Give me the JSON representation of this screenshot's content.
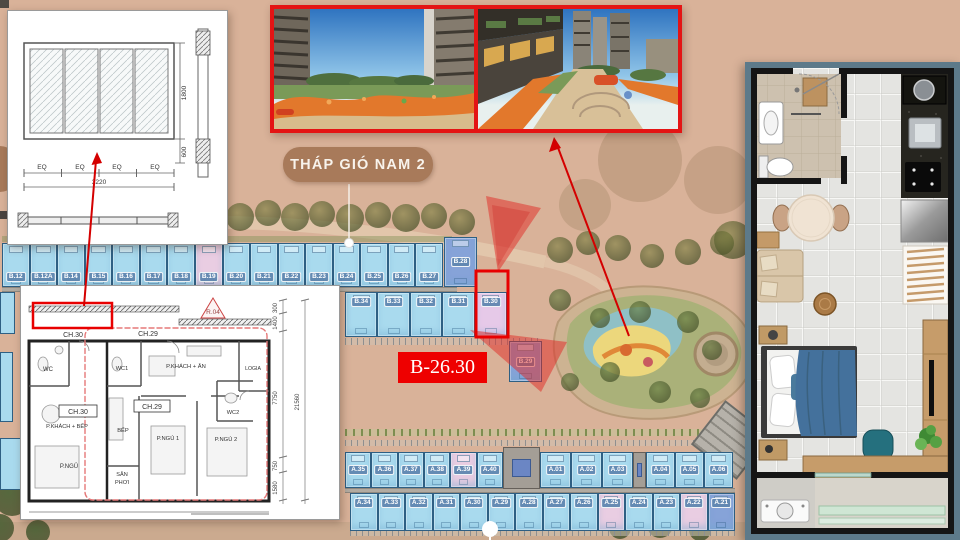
{
  "labels": {
    "tower_label": "THÁP GIÓ NAM 2",
    "unit_code": "B-26.30",
    "partial_tower_letter": "T"
  },
  "window_detail": {
    "height": "1800",
    "sill": "600",
    "total": "3220",
    "eq": "EQ"
  },
  "floor_plan": {
    "ch30": "CH.30",
    "ch29": "CH.29",
    "r04": "R.04",
    "wc": "WC",
    "wc1": "WC1",
    "wc2": "WC2",
    "living30": "P.KHÁCH + BẾP",
    "bed30": "P.NGỦ",
    "living29": "P.KHÁCH + ĂN",
    "logia": "LOGIA",
    "kitchen": "BẾP",
    "bed1": "P.NGỦ 1",
    "bed2": "P.NGỦ 2",
    "san": "SÂN",
    "phoi": "PHƠI",
    "dims": [
      "300",
      "1400",
      "21560",
      "7750",
      "750",
      "1580"
    ]
  },
  "site_plan": {
    "b_top": [
      {
        "label": "B.12",
        "type": "std"
      },
      {
        "label": "B.12A",
        "type": "std"
      },
      {
        "label": "B.14",
        "type": "std"
      },
      {
        "label": "B.15",
        "type": "std"
      },
      {
        "label": "B.16",
        "type": "std"
      },
      {
        "label": "B.17",
        "type": "std"
      },
      {
        "label": "B.18",
        "type": "std"
      },
      {
        "label": "B.19",
        "type": "pink"
      },
      {
        "label": "B.20",
        "type": "std"
      },
      {
        "label": "B.21",
        "type": "std"
      },
      {
        "label": "B.22",
        "type": "std"
      },
      {
        "label": "B.23",
        "type": "std"
      },
      {
        "label": "B.24",
        "type": "std"
      },
      {
        "label": "B.25",
        "type": "std"
      },
      {
        "label": "B.26",
        "type": "std"
      },
      {
        "label": "B.27",
        "type": "std"
      }
    ],
    "b_28": {
      "label": "B.28",
      "type": "dark"
    },
    "b_bottom": [
      {
        "label": "B.34",
        "type": "std"
      },
      {
        "label": "B.33",
        "type": "std"
      },
      {
        "label": "B.32",
        "type": "std"
      },
      {
        "label": "B.31",
        "type": "std"
      },
      {
        "label": "B.30",
        "type": "highlight"
      }
    ],
    "b_29": {
      "label": "B.29",
      "type": "dark"
    },
    "a_top_left": [
      {
        "label": "A.35",
        "type": "std"
      },
      {
        "label": "A.36",
        "type": "std"
      },
      {
        "label": "A.37",
        "type": "std"
      },
      {
        "label": "A.38",
        "type": "std"
      },
      {
        "label": "A.39",
        "type": "pink"
      },
      {
        "label": "A.40",
        "type": "std"
      }
    ],
    "a_top_mid": [
      {
        "label": "A.01",
        "type": "std"
      },
      {
        "label": "A.02",
        "type": "std"
      },
      {
        "label": "A.03",
        "type": "std"
      }
    ],
    "a_top_right": [
      {
        "label": "A.04",
        "type": "std"
      },
      {
        "label": "A.05",
        "type": "std"
      },
      {
        "label": "A.06",
        "type": "std"
      }
    ],
    "a_bottom": [
      {
        "label": "A.34",
        "type": "std"
      },
      {
        "label": "A.33",
        "type": "std"
      },
      {
        "label": "A.32",
        "type": "std"
      },
      {
        "label": "A.31",
        "type": "std"
      },
      {
        "label": "A.30",
        "type": "std"
      },
      {
        "label": "A.29",
        "type": "std"
      },
      {
        "label": "A.28",
        "type": "std"
      },
      {
        "label": "A.27",
        "type": "std"
      },
      {
        "label": "A.26",
        "type": "std"
      },
      {
        "label": "A.25",
        "type": "pink"
      },
      {
        "label": "A.24",
        "type": "std"
      },
      {
        "label": "A.23",
        "type": "std"
      },
      {
        "label": "A.22",
        "type": "pink"
      },
      {
        "label": "A.21",
        "type": "dark"
      }
    ]
  },
  "colors": {
    "background_tan": "#d9b299",
    "accent_red": "#e60000",
    "unit_blue": "#a9daee",
    "unit_pink": "#e9cde2",
    "unit_dark_blue": "#86a3d8",
    "label_brown": "#a87a5a",
    "panel_border": "#5d7a8a"
  }
}
